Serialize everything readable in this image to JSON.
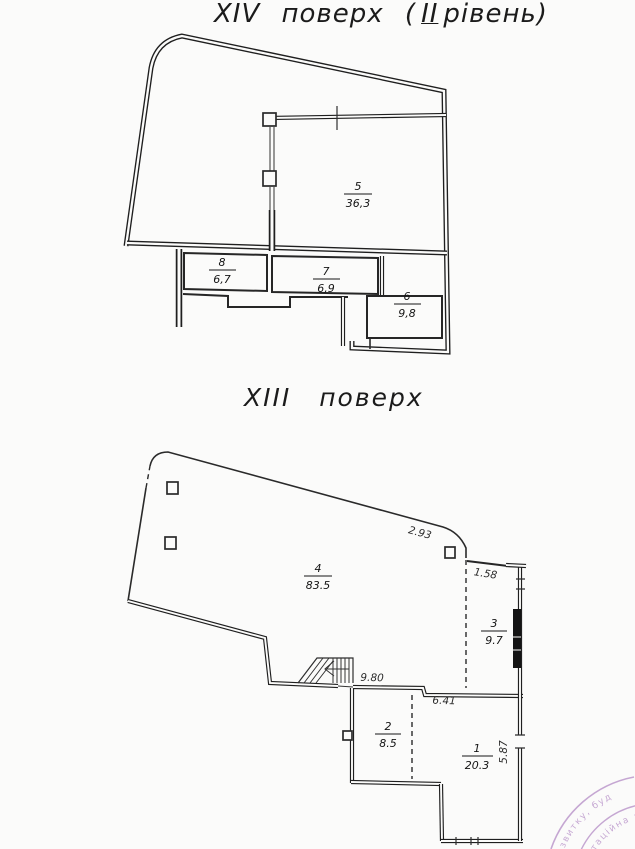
{
  "titles": {
    "floor14": {
      "main": "XIV поверх (",
      "level": "ІІ",
      "rest": "рівень)"
    },
    "floor13": "XIII поверх"
  },
  "plan14": {
    "rooms": [
      {
        "number": "5",
        "area": "36,3"
      },
      {
        "number": "8",
        "area": "6,7"
      },
      {
        "number": "7",
        "area": "6,9"
      },
      {
        "number": "6",
        "area": "9,8"
      }
    ]
  },
  "plan13": {
    "rooms": [
      {
        "number": "4",
        "area": "83.5"
      },
      {
        "number": "3",
        "area": "9.7"
      },
      {
        "number": "2",
        "area": "8.5"
      },
      {
        "number": "1",
        "area": "20.3"
      }
    ],
    "dims": {
      "top_edge": "2.93",
      "room3_top": "1.58",
      "stair_wall": "9.80",
      "room1_top": "6.41",
      "room1_right": "5.87"
    }
  },
  "stamp": {
    "outer_text": "звитку, буд",
    "inner_text": "таційна з",
    "color": "#9a63b3"
  }
}
